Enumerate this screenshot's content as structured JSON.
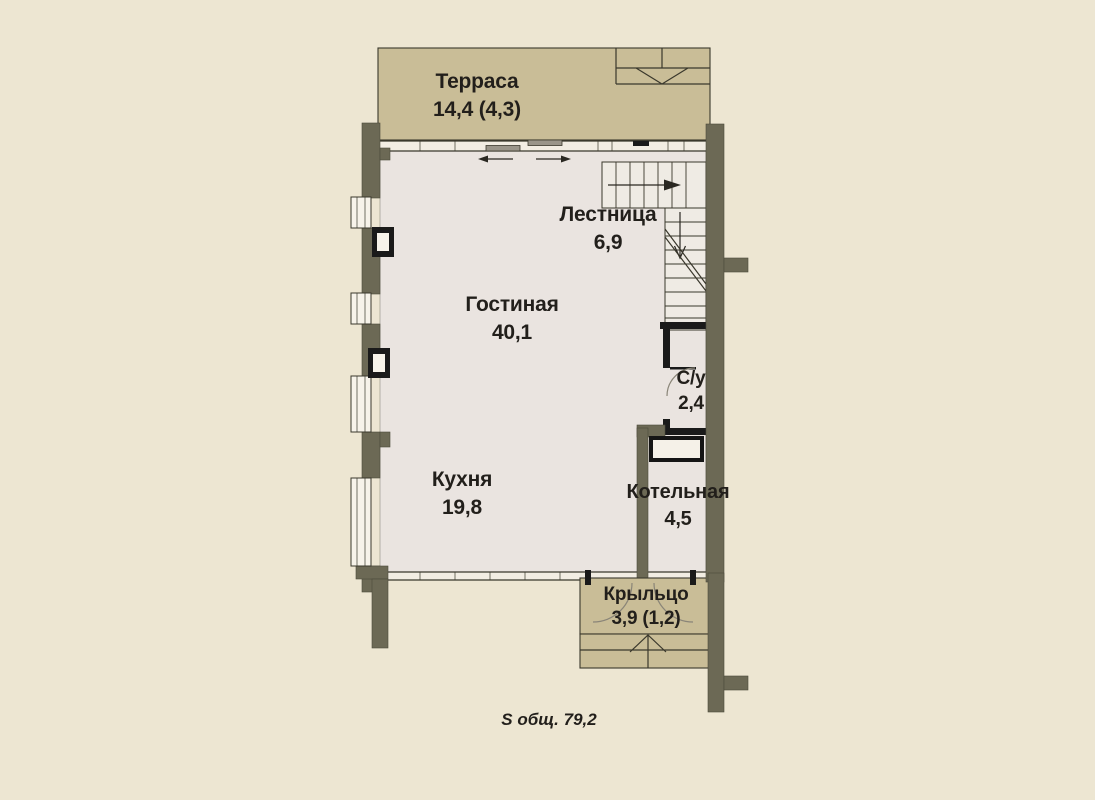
{
  "rooms": {
    "terrace": {
      "name": "Терраса",
      "area": "14,4 (4,3)"
    },
    "stairs": {
      "name": "Лестница",
      "area": "6,9"
    },
    "living": {
      "name": "Гостиная",
      "area": "40,1"
    },
    "bathroom": {
      "name": "С/у",
      "area": "2,4"
    },
    "kitchen": {
      "name": "Кухня",
      "area": "19,8"
    },
    "boiler": {
      "name": "Котельная",
      "area": "4,5"
    },
    "porch": {
      "name": "Крыльцо",
      "area": "3,9 (1,2)"
    }
  },
  "total_area_label": "S общ. 79,2",
  "colors": {
    "background": "#EDE6D2",
    "terrace_fill": "#C9BD97",
    "interior_fill": "#EAE4E0",
    "wall": "#6C6955",
    "line": "#3A382C",
    "black_wall": "#1A1A1A",
    "label_text": "#221F1B"
  }
}
